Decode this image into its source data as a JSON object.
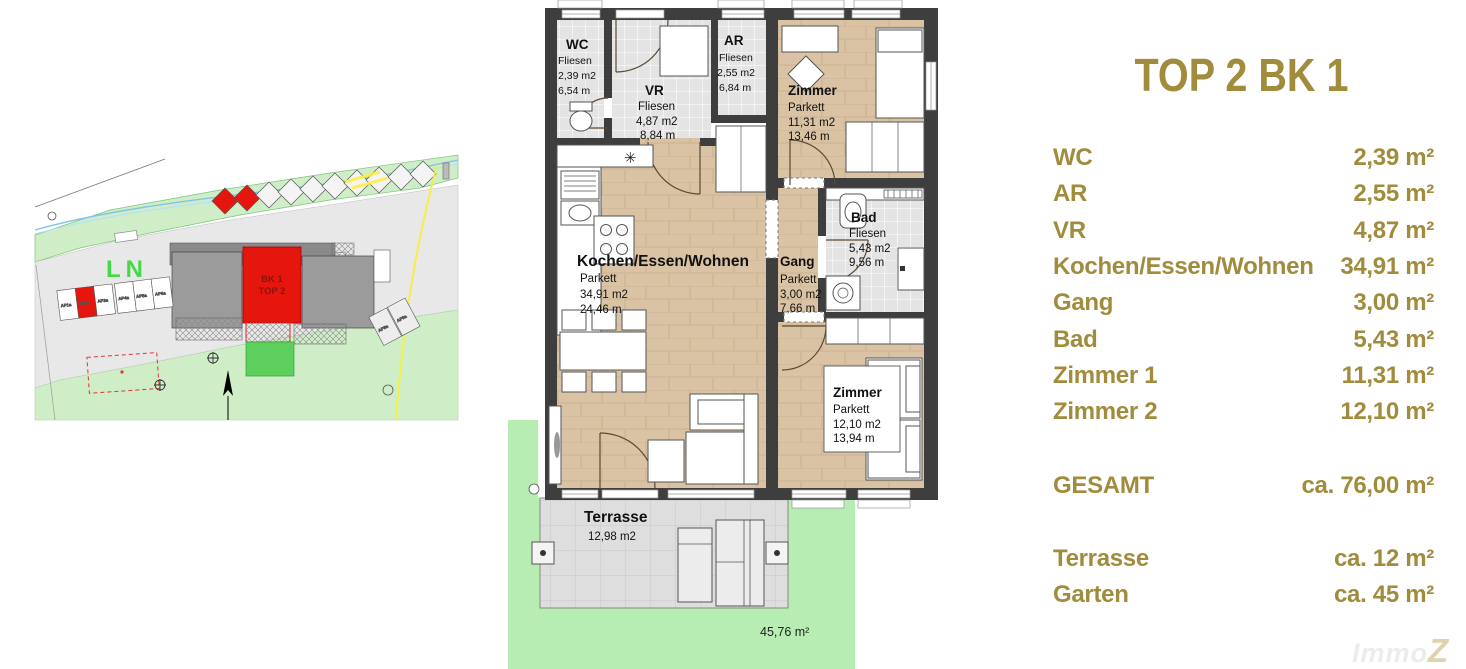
{
  "summary": {
    "title": "TOP 2 BK 1",
    "rows": [
      {
        "label": "WC",
        "value": "2,39 m²"
      },
      {
        "label": "AR",
        "value": "2,55 m²"
      },
      {
        "label": "VR",
        "value": "4,87 m²"
      },
      {
        "label": "Kochen/Essen/Wohnen",
        "value": "34,91 m²"
      },
      {
        "label": "Gang",
        "value": "3,00 m²"
      },
      {
        "label": "Bad",
        "value": "5,43 m²"
      },
      {
        "label": "Zimmer 1",
        "value": "11,31 m²"
      },
      {
        "label": "Zimmer 2",
        "value": "12,10 m²"
      }
    ],
    "total": {
      "label": "GESAMT",
      "value": "ca. 76,00 m²"
    },
    "outdoor": [
      {
        "label": "Terrasse",
        "value": "ca. 12 m²"
      },
      {
        "label": "Garten",
        "value": "ca. 45 m²"
      }
    ]
  },
  "floorplan": {
    "rooms": [
      {
        "name": "WC",
        "floor": "Fliesen",
        "area": "2,39 m2",
        "dim": "6,54 m"
      },
      {
        "name": "VR",
        "floor": "Fliesen",
        "area": "4,87 m2",
        "dim": "8,84 m"
      },
      {
        "name": "AR",
        "floor": "Fliesen",
        "area": "2,55 m2",
        "dim": "6,84 m"
      },
      {
        "name": "Zimmer",
        "floor": "Parkett",
        "area": "11,31 m2",
        "dim": "13,46 m"
      },
      {
        "name": "Kochen/Essen/Wohnen",
        "floor": "Parkett",
        "area": "34,91 m2",
        "dim": "24,46 m"
      },
      {
        "name": "Gang",
        "floor": "Parkett",
        "area": "3,00 m2",
        "dim": "7,66 m"
      },
      {
        "name": "Bad",
        "floor": "Fliesen",
        "area": "5,43 m2",
        "dim": "9,56 m"
      },
      {
        "name": "Zimmer",
        "floor": "Parkett",
        "area": "12,10 m2",
        "dim": "13,94 m"
      }
    ],
    "terrace": {
      "name": "Terrasse",
      "area": "12,98 m2"
    },
    "garden_area": "45,76 m²",
    "symbols": {
      "vent": "✳"
    }
  },
  "siteplan": {
    "zone_label": "LN",
    "unit_lines": [
      "BK 1",
      "TOP 2"
    ],
    "parking_left": [
      "AP1a",
      "AP2a",
      "AP3a",
      "AP4a",
      "AP5a",
      "AP6a"
    ],
    "parking_right": [
      "AP8a",
      "AP9a"
    ]
  },
  "watermark": {
    "prefix": "Immo",
    "suffix": "Z"
  },
  "colors": {
    "accent_gold": "#a08c3c",
    "highlight_red": "#e6150d",
    "wall_dark": "#3e3e3e",
    "parkett": "#d9c3a4",
    "fliesen": "#e2e2e2",
    "garden_green": "#b7ecb2",
    "site_green_light": "#cfeec8"
  }
}
